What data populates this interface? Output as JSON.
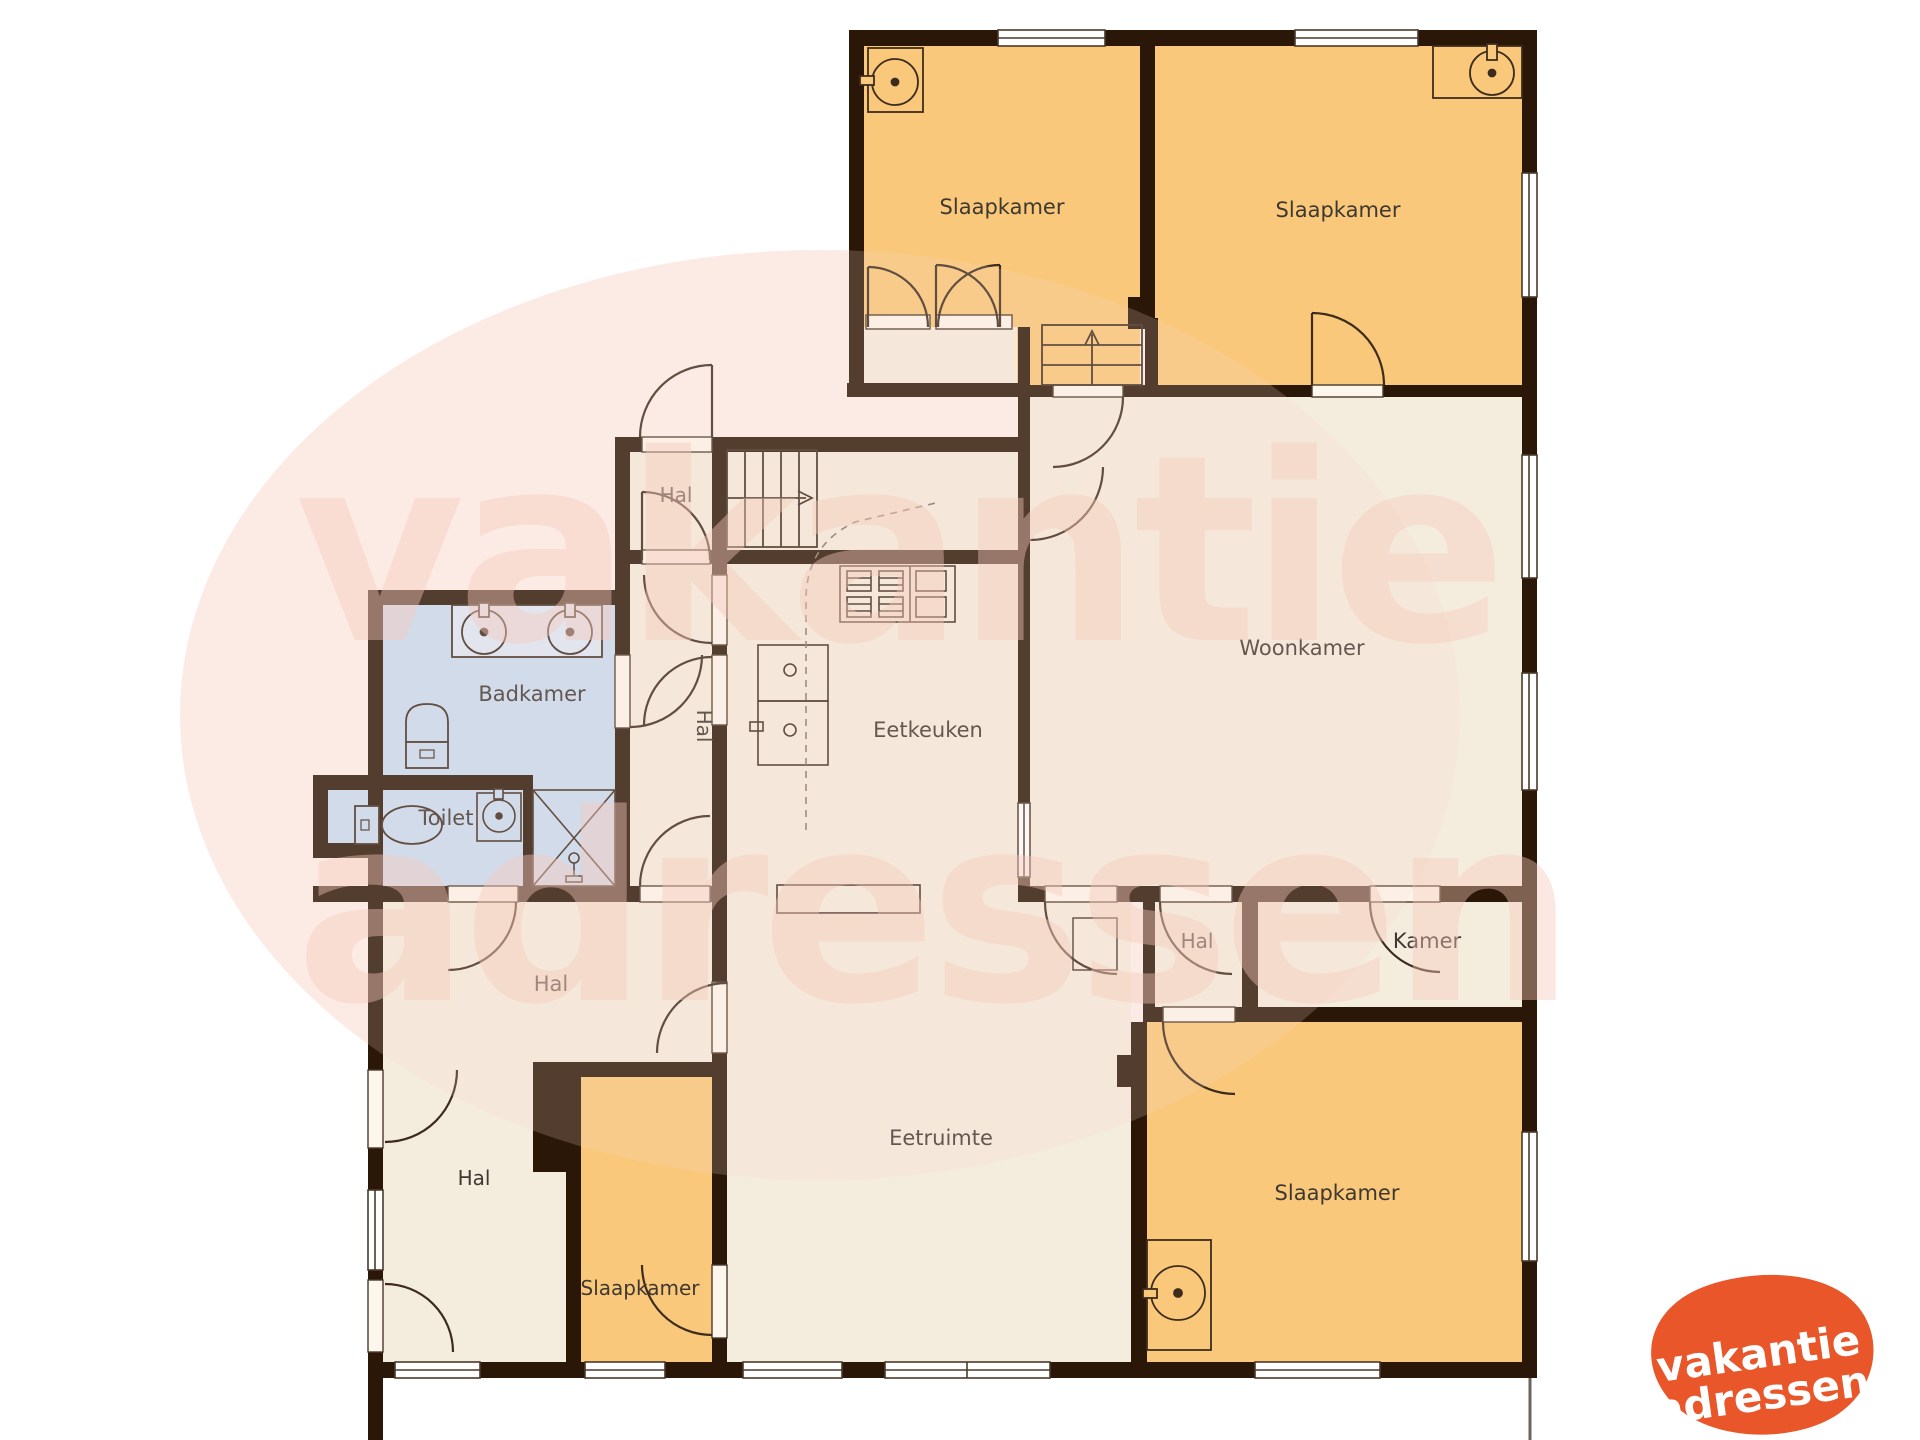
{
  "plan": {
    "title": "floor-plan",
    "rooms": {
      "slaapkamer_top_left": "Slaapkamer",
      "slaapkamer_top_right": "Slaapkamer",
      "woonkamer": "Woonkamer",
      "hal_entrance": "Hal",
      "hal_corridor": "Hal",
      "eetkeuken": "Eetkeuken",
      "badkamer": "Badkamer",
      "toilet": "Toilet",
      "hal_main": "Hal",
      "hal_lower": "Hal",
      "eetruimte": "Eetruimte",
      "hal_right": "Hal",
      "kamer": "Kamer",
      "slaapkamer_bottom_left": "Slaapkamer",
      "slaapkamer_bottom_right": "Slaapkamer"
    },
    "fixtures": [
      "sink",
      "sink",
      "sink",
      "double-vanity",
      "toilet",
      "toilet",
      "shower",
      "stove",
      "kitchen-sink",
      "stairs-up",
      "stairs-up"
    ],
    "colors": {
      "wall": "#2a1708",
      "room_beige": "#f4edde",
      "room_orange": "#f9c87a",
      "room_blue": "#c8dcf2",
      "vanity_blue": "#dde9f7",
      "blob_pink": "#fdf0ea",
      "logo_orange": "#e8562a",
      "label": "#3e3831"
    }
  },
  "watermark": {
    "line1": "vakantie",
    "line2": "adressen"
  },
  "logo": {
    "line1": "vakantie",
    "line2": "adressen"
  }
}
